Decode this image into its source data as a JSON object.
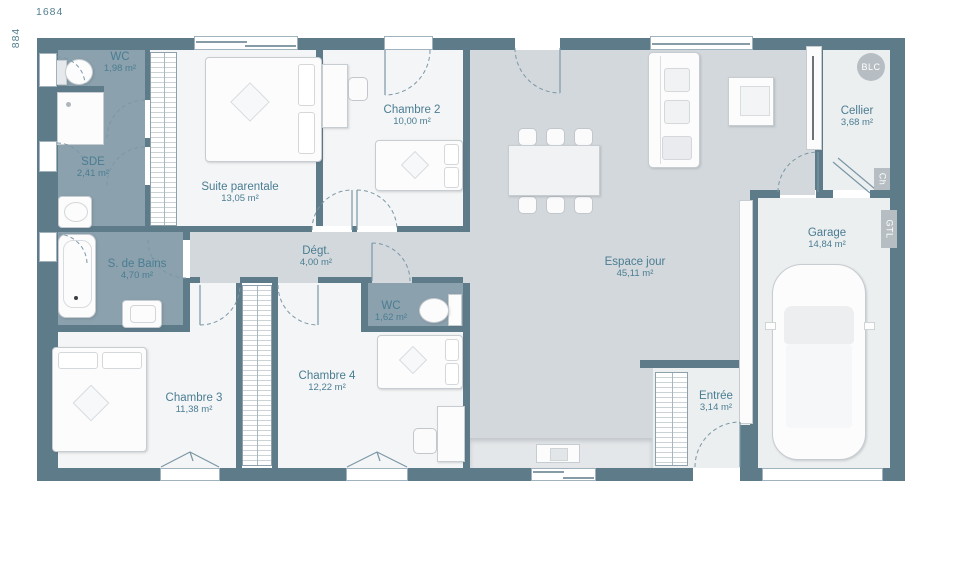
{
  "dimensions": {
    "width_label": "1684",
    "height_label": "884"
  },
  "rooms": [
    {
      "id": "wc1",
      "name": "WC",
      "area": "1,98 m²"
    },
    {
      "id": "sde",
      "name": "SDE",
      "area": "2,41 m²"
    },
    {
      "id": "suite_parentale",
      "name": "Suite parentale",
      "area": "13,05 m²"
    },
    {
      "id": "chambre2",
      "name": "Chambre 2",
      "area": "10,00 m²"
    },
    {
      "id": "salle_de_bains",
      "name": "S. de Bains",
      "area": "4,70 m²"
    },
    {
      "id": "degagement",
      "name": "Dégt.",
      "area": "4,00 m²"
    },
    {
      "id": "wc2",
      "name": "WC",
      "area": "1,62 m²"
    },
    {
      "id": "chambre3",
      "name": "Chambre 3",
      "area": "11,38 m²"
    },
    {
      "id": "chambre4",
      "name": "Chambre 4",
      "area": "12,22 m²"
    },
    {
      "id": "espace_jour",
      "name": "Espace jour",
      "area": "45,11 m²"
    },
    {
      "id": "entree",
      "name": "Entrée",
      "area": "3,14 m²"
    },
    {
      "id": "cellier",
      "name": "Cellier",
      "area": "3,68 m²"
    },
    {
      "id": "garage",
      "name": "Garage",
      "area": "14,84 m²"
    }
  ],
  "technical_labels": {
    "blc": "BLC",
    "ch": "Ch",
    "gtl": "GTL"
  },
  "colors": {
    "wall": "#5e7b8a",
    "wet_floor": "#8ba1ad",
    "living_floor": "#d3d8dc",
    "bedroom_floor": "#f4f5f6",
    "utility_floor": "#eceff0",
    "label_text": "#4a7d92",
    "badge": "#b7bec3"
  }
}
